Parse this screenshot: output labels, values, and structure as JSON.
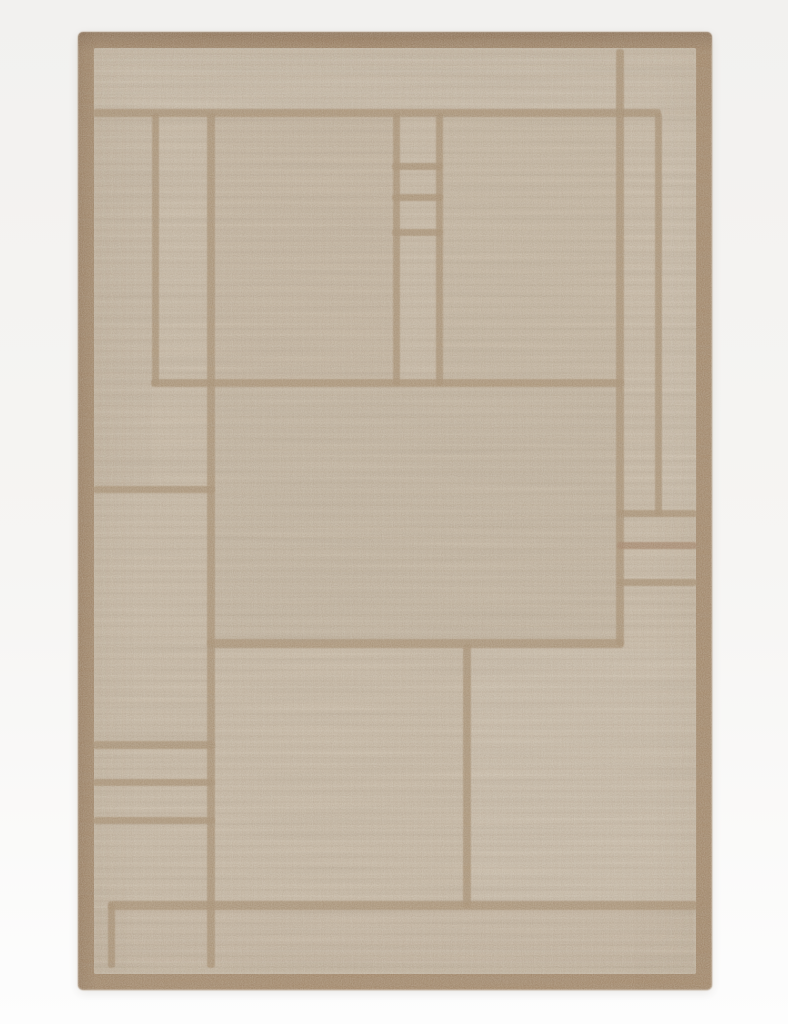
{
  "image": {
    "type": "product-photograph",
    "subject": "hand-tufted geometric wool area rug",
    "style": "mid-century / craftsman block pattern",
    "orientation": "portrait",
    "background": "seamless studio white"
  },
  "colors": {
    "bg_top": "#f2f1ef",
    "bg_bottom": "#fdfdfd",
    "rug_border": "#a28668",
    "rug_field": "#c8baa7",
    "pattern_line": "#a78e70",
    "pattern_line_warm": "#a48266"
  },
  "rug": {
    "left": 78,
    "top": 32,
    "width": 634,
    "height": 958,
    "border_px": 16,
    "line_px": 7
  },
  "pattern": {
    "verticals": [
      {
        "x": 155,
        "y1": 113,
        "y2": 386
      },
      {
        "x": 211,
        "y1": 113,
        "y2": 968,
        "t": 8
      },
      {
        "x": 396,
        "y1": 113,
        "y2": 386
      },
      {
        "x": 439,
        "y1": 113,
        "y2": 386
      },
      {
        "x": 620,
        "y1": 49,
        "y2": 646,
        "t": 8
      },
      {
        "x": 658,
        "y1": 113,
        "y2": 516
      },
      {
        "x": 467,
        "y1": 643,
        "y2": 908,
        "t": 8
      },
      {
        "x": 111,
        "y1": 903,
        "y2": 968
      }
    ],
    "horizontals": [
      {
        "y": 113,
        "x1": 93,
        "x2": 661,
        "t": 8
      },
      {
        "y": 166,
        "x1": 392,
        "x2": 443
      },
      {
        "y": 197,
        "x1": 392,
        "x2": 443
      },
      {
        "y": 232,
        "x1": 392,
        "x2": 443
      },
      {
        "y": 383,
        "x1": 151,
        "x2": 624,
        "t": 8
      },
      {
        "y": 489,
        "x1": 93,
        "x2": 215
      },
      {
        "y": 513,
        "x1": 617,
        "x2": 697
      },
      {
        "y": 545,
        "x1": 617,
        "x2": 697,
        "warm": true
      },
      {
        "y": 582,
        "x1": 617,
        "x2": 697
      },
      {
        "y": 643,
        "x1": 207,
        "x2": 624,
        "t": 9
      },
      {
        "y": 745,
        "x1": 93,
        "x2": 215,
        "t": 8
      },
      {
        "y": 782,
        "x1": 93,
        "x2": 215
      },
      {
        "y": 820,
        "x1": 93,
        "x2": 215
      },
      {
        "y": 905,
        "x1": 108,
        "x2": 697,
        "t": 9
      }
    ],
    "regions": [
      {
        "x": 93,
        "y": 49,
        "w": 604,
        "h": 62,
        "c": "rgba(255,255,252,0.05)"
      },
      {
        "x": 93,
        "y": 116,
        "w": 59,
        "h": 370,
        "c": "rgba(150,132,108,0.05)"
      },
      {
        "x": 214,
        "y": 116,
        "w": 179,
        "h": 265,
        "c": "rgba(150,130,105,0.08)"
      },
      {
        "x": 443,
        "y": 116,
        "w": 174,
        "h": 265,
        "c": "rgba(150,130,105,0.06)"
      },
      {
        "x": 214,
        "y": 387,
        "w": 403,
        "h": 253,
        "c": "rgba(148,130,106,0.07)"
      },
      {
        "x": 661,
        "y": 116,
        "w": 36,
        "h": 395,
        "c": "rgba(255,255,250,0.06)"
      },
      {
        "x": 470,
        "y": 647,
        "w": 227,
        "h": 255,
        "c": "rgba(255,255,250,0.05)"
      },
      {
        "x": 93,
        "y": 908,
        "w": 600,
        "h": 60,
        "c": "rgba(150,132,108,0.04)"
      }
    ]
  }
}
